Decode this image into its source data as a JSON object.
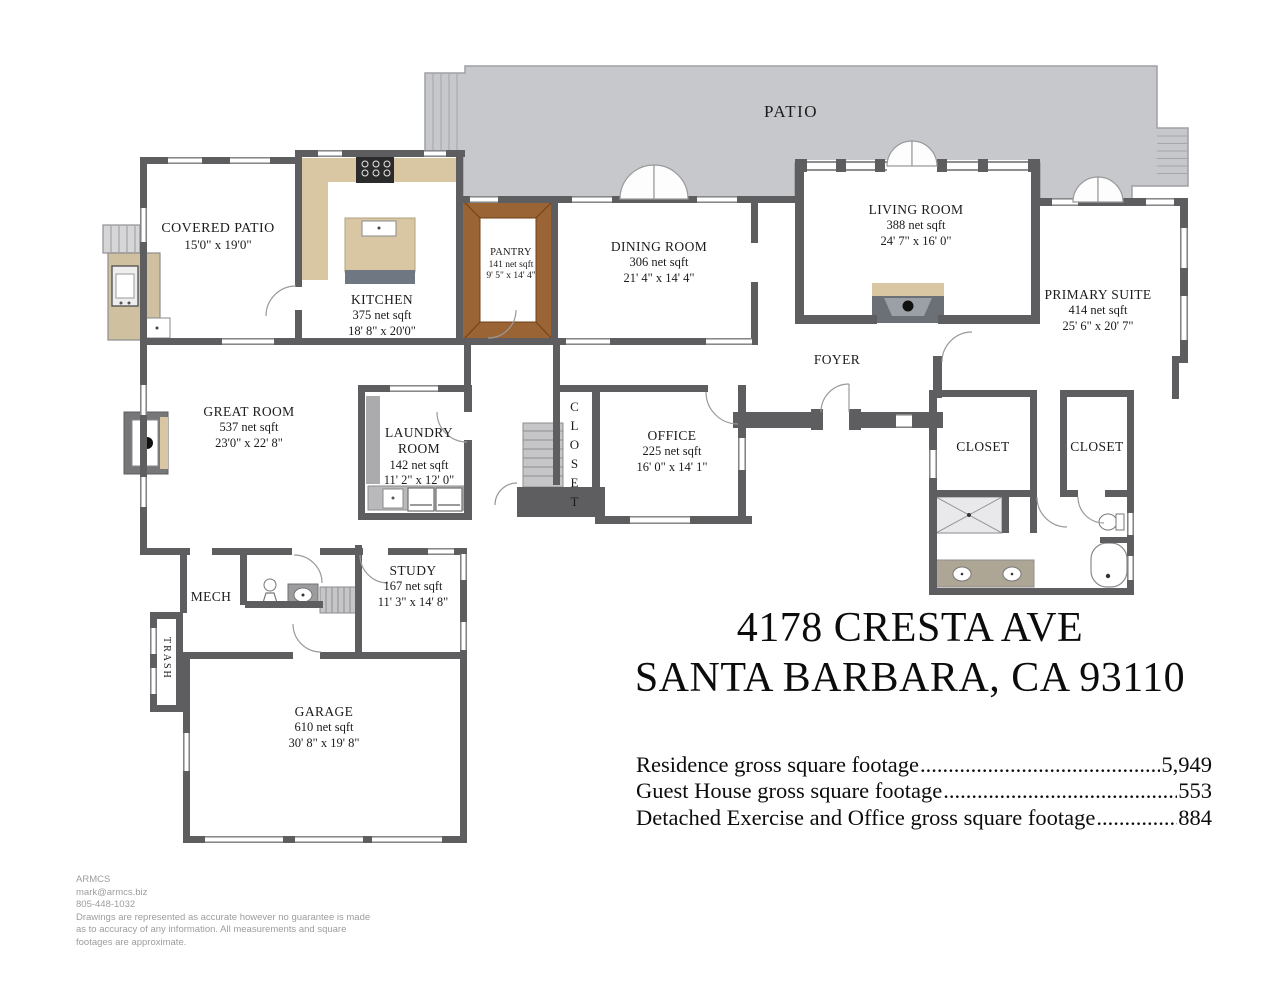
{
  "rooms": [
    {
      "name": "PATIO"
    },
    {
      "name": "COVERED PATIO",
      "dims": "15'0\" x 19'0\""
    },
    {
      "name": "KITCHEN",
      "sqft": "375 net sqft",
      "dims": "18' 8\" x 20'0\""
    },
    {
      "name": "PANTRY",
      "sqft": "141 net sqft",
      "dims": "9' 5\" x 14' 4\""
    },
    {
      "name": "DINING ROOM",
      "sqft": "306 net sqft",
      "dims": "21' 4\" x 14' 4\""
    },
    {
      "name": "LIVING ROOM",
      "sqft": "388 net sqft",
      "dims": "24' 7\" x 16' 0\""
    },
    {
      "name": "PRIMARY SUITE",
      "sqft": "414 net sqft",
      "dims": "25' 6\" x 20' 7\""
    },
    {
      "name": "FOYER"
    },
    {
      "name": "GREAT ROOM",
      "sqft": "537 net sqft",
      "dims": "23'0\" x 22' 8\""
    },
    {
      "name": "LAUNDRY ROOM",
      "sqft": "142 net sqft",
      "dims": "11' 2\" x 12' 0\""
    },
    {
      "name": "CLOSET"
    },
    {
      "name": "CLOSET"
    },
    {
      "name": "CLOSET"
    },
    {
      "name": "OFFICE",
      "sqft": "225 net sqft",
      "dims": "16' 0\" x 14' 1\""
    },
    {
      "name": "MECH"
    },
    {
      "name": "STUDY",
      "sqft": "167 net sqft",
      "dims": "11' 3\" x 14' 8\""
    },
    {
      "name": "TRASH"
    },
    {
      "name": "GARAGE",
      "sqft": "610 net sqft",
      "dims": "30' 8\" x 19' 8\""
    }
  ],
  "title": {
    "line1": "4178 CRESTA AVE",
    "line2": "SANTA BARBARA, CA 93110"
  },
  "footage": [
    {
      "label": "Residence gross square footage",
      "value": "5,949"
    },
    {
      "label": "Guest House gross square footage",
      "value": "553"
    },
    {
      "label": "Detached Exercise and Office gross square footage",
      "value": "884"
    }
  ],
  "footer": {
    "company": "ARMCS",
    "email": "mark@armcs.biz",
    "phone": "805-448-1032",
    "disclaimer1": "Drawings are represented as accurate however no guarantee is made",
    "disclaimer2": "as to accuracy of any information. All measurements and square",
    "disclaimer3": "footages are approximate."
  },
  "colors": {
    "wall": "#5e5e60",
    "patio": "#c7c8cc",
    "counter_tan": "#d8c7a2",
    "pantry_wood": "#9b6434"
  }
}
